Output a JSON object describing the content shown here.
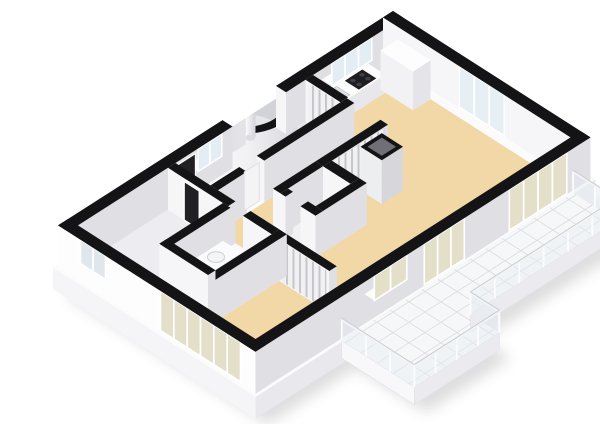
{
  "scene": {
    "background": "#ffffff",
    "projection": {
      "ox": 393,
      "oy": 64,
      "kx": 25,
      "ky": 16,
      "kz": 19,
      "wall_height": 2.2
    },
    "palette": {
      "wall_top": "#141416",
      "face_south": "#f6f6f8",
      "face_east": "#dfdfe4",
      "slab_top": "#fbfbfc",
      "slab_south": "#f5f5f7",
      "slab_east": "#e9e9ed",
      "glass": "#dce9f1",
      "frame": "#ffffff",
      "dark_door": "#212125",
      "slat_base": "#f1f1f4",
      "slat_line": "#c6c6cd",
      "deck": "#f6f7f8",
      "tile_line": "#d9dde0",
      "rail_glass": "#e7eef3",
      "floor_beige": "#f2d8a6",
      "floor_gray": "#e7e7eb",
      "floor_light": "#ededf1",
      "floor_white": "#f0f0f3",
      "floor_bath": "#cddce7",
      "shadow": "#32323e"
    },
    "slab": {
      "pts": [
        [
          -0.45,
          -0.45
        ],
        [
          7.65,
          -0.45
        ],
        [
          7.65,
          13.15
        ],
        [
          -0.45,
          13.15
        ]
      ],
      "depth": 1.15
    },
    "turret": {
      "name": "turret-round-room",
      "center": [
        -0.55,
        5.4
      ],
      "Ro": 1.5,
      "Ri": 1.2,
      "h": 2.2,
      "floor": "#e6e6ea",
      "inner_face": "#d2d3d9",
      "column": {
        "center": [
          -0.55,
          5.15
        ],
        "R": 0.14
      },
      "divider": {
        "r0": -0.68,
        "r1": -0.44,
        "d0": 5.45,
        "d1": 6.55
      },
      "clip": [
        [
          394.3,
          23
        ],
        [
          -110,
          345.8
        ],
        [
          -110,
          600
        ],
        [
          394.3,
          600
        ]
      ]
    },
    "balcony": {
      "name": "balcony",
      "decks": [
        {
          "r0": 7.55,
          "r1": 9.3,
          "d0": 0.35,
          "d1": 6.2
        },
        {
          "r0": 7.55,
          "r1": 10.45,
          "d0": 6.2,
          "d1": 9.6
        }
      ],
      "rail": [
        [
          7.55,
          0.35
        ],
        [
          9.3,
          0.35
        ],
        [
          9.3,
          6.2
        ],
        [
          10.45,
          6.2
        ],
        [
          10.45,
          9.6
        ],
        [
          7.55,
          9.6
        ]
      ],
      "fascia": [
        {
          "p": [
            9.3,
            0.35
          ],
          "q": [
            9.3,
            6.2
          ],
          "face": "east"
        },
        {
          "p": [
            10.45,
            6.2
          ],
          "q": [
            10.45,
            9.6
          ],
          "face": "east"
        },
        {
          "p": [
            7.55,
            9.6
          ],
          "q": [
            10.45,
            9.6
          ],
          "face": "south"
        }
      ],
      "tile_step": 0.64,
      "z_top": -0.12,
      "z_bot": -1.05,
      "rail_h": 1.0
    },
    "elements": [
      {
        "kind": "floor",
        "name": "floor-open-living-kitchen",
        "fill": "floor_beige",
        "poly": [
          [
            0.05,
            0.35
          ],
          [
            7.15,
            0.35
          ],
          [
            7.15,
            8.75
          ],
          [
            1.75,
            8.75
          ],
          [
            1.75,
            3.3
          ],
          [
            0.05,
            3.3
          ]
        ]
      },
      {
        "kind": "floor",
        "name": "floor-bedroom",
        "fill": "floor_beige",
        "poly": [
          [
            4.5,
            9.05
          ],
          [
            7.15,
            9.05
          ],
          [
            7.15,
            12.65
          ],
          [
            4.5,
            12.65
          ]
        ]
      },
      {
        "kind": "floor",
        "name": "floor-bedroom-doorway",
        "fill": "floor_beige",
        "poly": [
          [
            6.5,
            8.75
          ],
          [
            7.15,
            8.75
          ],
          [
            7.15,
            9.05
          ],
          [
            6.5,
            9.05
          ]
        ]
      },
      {
        "kind": "floor",
        "name": "floor-entry-hall",
        "fill": "floor_gray",
        "poly": [
          [
            0.05,
            3.55
          ],
          [
            1.45,
            3.55
          ],
          [
            1.45,
            8.75
          ],
          [
            0.05,
            8.75
          ]
        ]
      },
      {
        "kind": "floor",
        "name": "floor-turret-opening",
        "fill": "floor_gray",
        "poly": [
          [
            -0.35,
            4.33
          ],
          [
            0.05,
            4.33
          ],
          [
            0.05,
            6.47
          ],
          [
            -0.35,
            6.47
          ]
        ]
      },
      {
        "kind": "floor",
        "name": "floor-storage-room",
        "fill": "floor_light",
        "poly": [
          [
            0.05,
            9.05
          ],
          [
            2.25,
            9.05
          ],
          [
            2.25,
            11.6
          ],
          [
            4.2,
            11.6
          ],
          [
            4.2,
            12.65
          ],
          [
            0.05,
            12.65
          ]
        ]
      },
      {
        "kind": "floor",
        "name": "floor-wc",
        "fill": "floor_white",
        "poly": [
          [
            3.1,
            5.9
          ],
          [
            4.2,
            5.9
          ],
          [
            4.2,
            7.6
          ],
          [
            3.1,
            7.6
          ]
        ]
      },
      {
        "kind": "floor",
        "name": "floor-bathroom",
        "fill": "floor_bath",
        "poly": [
          [
            2.55,
            9.05
          ],
          [
            4.2,
            9.05
          ],
          [
            4.2,
            11.3
          ],
          [
            2.55,
            11.3
          ]
        ]
      },
      {
        "kind": "turret"
      },
      {
        "kind": "wall",
        "name": "wall-nw-upper",
        "r0": -0.35,
        "r1": 0.05,
        "d0": -0.35,
        "d1": 4.33,
        "face": "r",
        "openings": [
          {
            "a0": 0.9,
            "a1": 2.5,
            "type": "window",
            "sill": 1.0,
            "tint": "#e8eff4"
          }
        ]
      },
      {
        "kind": "wall",
        "name": "wall-nw-lower",
        "r0": -0.35,
        "r1": 0.05,
        "d0": 6.47,
        "d1": 13.05,
        "face": "r",
        "openings": [
          {
            "a0": 6.9,
            "a1": 7.85,
            "type": "window",
            "sill": 1.0,
            "tint": "#e8eff4"
          },
          {
            "a0": 7.95,
            "a1": 8.85,
            "type": "darkdoor"
          }
        ]
      },
      {
        "kind": "wall",
        "name": "wall-ne",
        "r0": -0.35,
        "r1": 7.55,
        "d0": -0.35,
        "d1": 0.05,
        "face": "d",
        "openings": [
          {
            "a0": 2.7,
            "a1": 4.5,
            "type": "glassdoor",
            "sill": 0.05,
            "tint": "#eef3f6"
          }
        ]
      },
      {
        "kind": "box",
        "name": "kitchen-counter",
        "r0": 0.05,
        "r1": 0.75,
        "d0": 1.05,
        "d1": 3.2,
        "z0": 0,
        "z1": 0.95,
        "top": "#fcfcfd",
        "south": "#f2f2f5",
        "east": "#e7e7ec"
      },
      {
        "kind": "panel",
        "name": "cooktop",
        "r0": 0.12,
        "r1": 0.68,
        "d0": 1.35,
        "d1": 2.05,
        "z": 0.95,
        "fill": "#1e1e22"
      },
      {
        "kind": "disc",
        "name": "burner",
        "c": [
          0.28,
          1.52
        ],
        "R": 0.08,
        "z": 0.95,
        "fill": "#3f3f46"
      },
      {
        "kind": "disc",
        "name": "burner",
        "c": [
          0.52,
          1.52
        ],
        "R": 0.08,
        "z": 0.95,
        "fill": "#3f3f46"
      },
      {
        "kind": "disc",
        "name": "burner",
        "c": [
          0.28,
          1.88
        ],
        "R": 0.08,
        "z": 0.95,
        "fill": "#3f3f46"
      },
      {
        "kind": "disc",
        "name": "burner",
        "c": [
          0.52,
          1.88
        ],
        "R": 0.08,
        "z": 0.95,
        "fill": "#3f3f46"
      },
      {
        "kind": "panel",
        "name": "kitchen-sink",
        "r0": 0.14,
        "r1": 0.66,
        "d0": 2.4,
        "d1": 2.95,
        "z": 0.95,
        "fill": "#eef1f3",
        "stroke": "#bfc5c9"
      },
      {
        "kind": "panel",
        "name": "kitchen-sink-basin",
        "r0": 0.2,
        "r1": 0.6,
        "d0": 2.47,
        "d1": 2.88,
        "z": 0.95,
        "fill": "#e2e7ea",
        "stroke": "#cfd4d8"
      },
      {
        "kind": "box",
        "name": "kitchen-tall-cabinet",
        "r0": 0.55,
        "r1": 1.85,
        "d0": 0.35,
        "d1": 1.05,
        "z0": 0,
        "z1": 2.05,
        "top": "#fdfdfe",
        "south": "#f2f2f5",
        "east": "#e4e4e9"
      },
      {
        "kind": "wall",
        "name": "wall-kitchen-entry",
        "r0": 0.05,
        "r1": 1.45,
        "d0": 3.25,
        "d1": 3.55,
        "face": "d",
        "slats": [
          0.15,
          1.35
        ]
      },
      {
        "kind": "wall",
        "name": "wall-entry-hall-upper",
        "r0": 1.45,
        "r1": 1.75,
        "d0": 3.3,
        "d1": 6.9,
        "face": "r"
      },
      {
        "kind": "wall",
        "name": "wall-entry-hall-lower",
        "r0": 1.45,
        "r1": 1.75,
        "d0": 7.6,
        "d1": 8.75,
        "face": "r"
      },
      {
        "kind": "leaf",
        "name": "entry-door-leaf",
        "r": 1.6,
        "d0": 6.95,
        "d1": 7.55,
        "z1": 2.02,
        "fill": "#f4f4f7"
      },
      {
        "kind": "wall",
        "name": "wall-hall-closets",
        "r0": 2.8,
        "r1": 3.1,
        "d0": 3.3,
        "d1": 5.9,
        "face": "r",
        "slats": [
          3.45,
          5.75
        ]
      },
      {
        "kind": "box",
        "name": "duct-column",
        "r0": 3.3,
        "r1": 4.15,
        "d0": 3.75,
        "d1": 4.6,
        "z0": 0,
        "z1": 2.3,
        "top": "#141416",
        "south": "#eceef0",
        "east": "#d6d6db"
      },
      {
        "kind": "panel",
        "name": "duct-column-shaft",
        "r0": 3.44,
        "r1": 4.01,
        "d0": 3.89,
        "d1": 4.46,
        "z": 2.3,
        "fill": "#6f6f75"
      },
      {
        "kind": "wall",
        "name": "wall-wc-north",
        "r0": 3.1,
        "r1": 4.2,
        "d0": 5.55,
        "d1": 5.9,
        "face": "d"
      },
      {
        "kind": "wall",
        "name": "wall-wc-west",
        "r0": 2.8,
        "r1": 3.1,
        "d0": 5.9,
        "d1": 7.6,
        "face": "r"
      },
      {
        "kind": "box",
        "name": "wc-toilet-tank",
        "r0": 3.35,
        "r1": 3.82,
        "d0": 5.92,
        "d1": 6.14,
        "z0": 0,
        "z1": 0.72,
        "top": "#fafafc",
        "south": "#eff0f3",
        "east": "#e2e3e8"
      },
      {
        "kind": "disc",
        "name": "wc-toilet-base",
        "c": [
          3.58,
          6.42
        ],
        "R": 0.26,
        "z": 0.08,
        "fill": "#e6e8ec"
      },
      {
        "kind": "disc",
        "name": "wc-toilet-seat",
        "c": [
          3.58,
          6.38
        ],
        "R": 0.24,
        "z": 0.42,
        "fill": "#ffffff",
        "stroke": "#d8dcdf"
      },
      {
        "kind": "box",
        "name": "wc-basin",
        "r0": 3.96,
        "r1": 4.18,
        "d0": 6.72,
        "d1": 7.04,
        "z0": 0.7,
        "z1": 1.0,
        "top": "#ffffff",
        "south": "#f0f1f4",
        "east": "#e3e4e9"
      },
      {
        "kind": "wall",
        "name": "wall-wc-east",
        "r0": 4.2,
        "r1": 4.5,
        "d0": 5.55,
        "d1": 7.3,
        "face": "r"
      },
      {
        "kind": "wall",
        "name": "wall-wc-south-a",
        "r0": 3.1,
        "r1": 3.3,
        "d0": 7.3,
        "d1": 7.6,
        "face": "d"
      },
      {
        "kind": "wall",
        "name": "wall-wc-south-b",
        "r0": 3.9,
        "r1": 4.5,
        "d0": 7.3,
        "d1": 7.6,
        "face": "d"
      },
      {
        "kind": "box",
        "name": "entry-basin",
        "r0": 0.1,
        "r1": 0.38,
        "d0": 8.1,
        "d1": 8.5,
        "z0": 0.78,
        "z1": 1.02,
        "top": "#ffffff",
        "south": "#f0f1f4",
        "east": "#e3e4e9"
      },
      {
        "kind": "wall",
        "name": "wall-hall-south-a",
        "r0": 0.05,
        "r1": 2.45,
        "d0": 8.75,
        "d1": 9.05,
        "face": "d",
        "openings": [
          {
            "a0": 0.7,
            "a1": 1.3,
            "type": "darkdoor"
          }
        ]
      },
      {
        "kind": "wall",
        "name": "wall-hall-south-b",
        "r0": 3.05,
        "r1": 4.2,
        "d0": 8.75,
        "d1": 9.05,
        "face": "d"
      },
      {
        "kind": "wall",
        "name": "wall-bedroom-closets",
        "r0": 4.5,
        "r1": 6.5,
        "d0": 8.75,
        "d1": 9.05,
        "face": "d",
        "slats": [
          4.62,
          6.38
        ]
      },
      {
        "kind": "wall",
        "name": "wall-bathroom-west",
        "r0": 2.25,
        "r1": 2.55,
        "d0": 9.05,
        "d1": 11.6,
        "face": "r"
      },
      {
        "kind": "box",
        "name": "bathroom-vanity",
        "r0": 2.6,
        "r1": 3.35,
        "d0": 9.4,
        "d1": 10.75,
        "z0": 0,
        "z1": 0.8,
        "top": "#fbfbfd",
        "south": "#f3f3f6",
        "east": "#ebebef"
      },
      {
        "kind": "disc",
        "name": "vanity-basin",
        "c": [
          2.97,
          10.05
        ],
        "R": 0.24,
        "z": 0.8,
        "fill": "#f3f5f7",
        "stroke": "#ccd1d5"
      },
      {
        "kind": "box",
        "name": "toilet-tank",
        "r0": 3.92,
        "r1": 4.16,
        "d0": 10.12,
        "d1": 10.68,
        "z0": 0,
        "z1": 0.76,
        "top": "#fafafc",
        "south": "#eff0f3",
        "east": "#e2e3e8"
      },
      {
        "kind": "disc",
        "name": "toilet-base",
        "c": [
          3.66,
          10.4
        ],
        "R": 0.28,
        "z": 0.06,
        "fill": "#e6e8ec"
      },
      {
        "kind": "disc",
        "name": "toilet-seat",
        "c": [
          3.66,
          10.36
        ],
        "R": 0.26,
        "z": 0.44,
        "fill": "#ffffff",
        "stroke": "#d8dcdf"
      },
      {
        "kind": "wall",
        "name": "wall-bedroom-west",
        "r0": 4.2,
        "r1": 4.5,
        "d0": 8.75,
        "d1": 12.65,
        "face": "r"
      },
      {
        "kind": "wall",
        "name": "wall-bathroom-south",
        "r0": 2.25,
        "r1": 4.2,
        "d0": 11.3,
        "d1": 11.6,
        "face": "d"
      },
      {
        "kind": "wall",
        "name": "wall-se",
        "r0": 7.15,
        "r1": 7.55,
        "d0": -0.35,
        "d1": 13.05,
        "face": "r",
        "openings": [
          {
            "a0": 0.6,
            "a1": 2.9,
            "type": "glassdoor",
            "sill": 0.05,
            "tint": "#ead7ad"
          },
          {
            "a0": 4.7,
            "a1": 6.3,
            "type": "glassdoor",
            "sill": 0.05,
            "tint": "#ead7ad"
          },
          {
            "a0": 7.0,
            "a1": 8.3,
            "type": "window",
            "sill": 0.9,
            "tint": "#ead7ad"
          }
        ]
      },
      {
        "kind": "wall",
        "name": "wall-sw",
        "r0": -0.35,
        "r1": 7.55,
        "d0": 12.65,
        "d1": 13.05,
        "face": "d",
        "fill": "#fdfdfe",
        "openings": [
          {
            "a0": 0.55,
            "a1": 1.55,
            "type": "window",
            "sill": 0.95,
            "tint": "#e4e6e9"
          },
          {
            "a0": 3.75,
            "a1": 6.95,
            "type": "glassdoor",
            "sill": 0.12,
            "tint": "#ead7ad"
          }
        ]
      },
      {
        "kind": "balcony"
      }
    ]
  }
}
